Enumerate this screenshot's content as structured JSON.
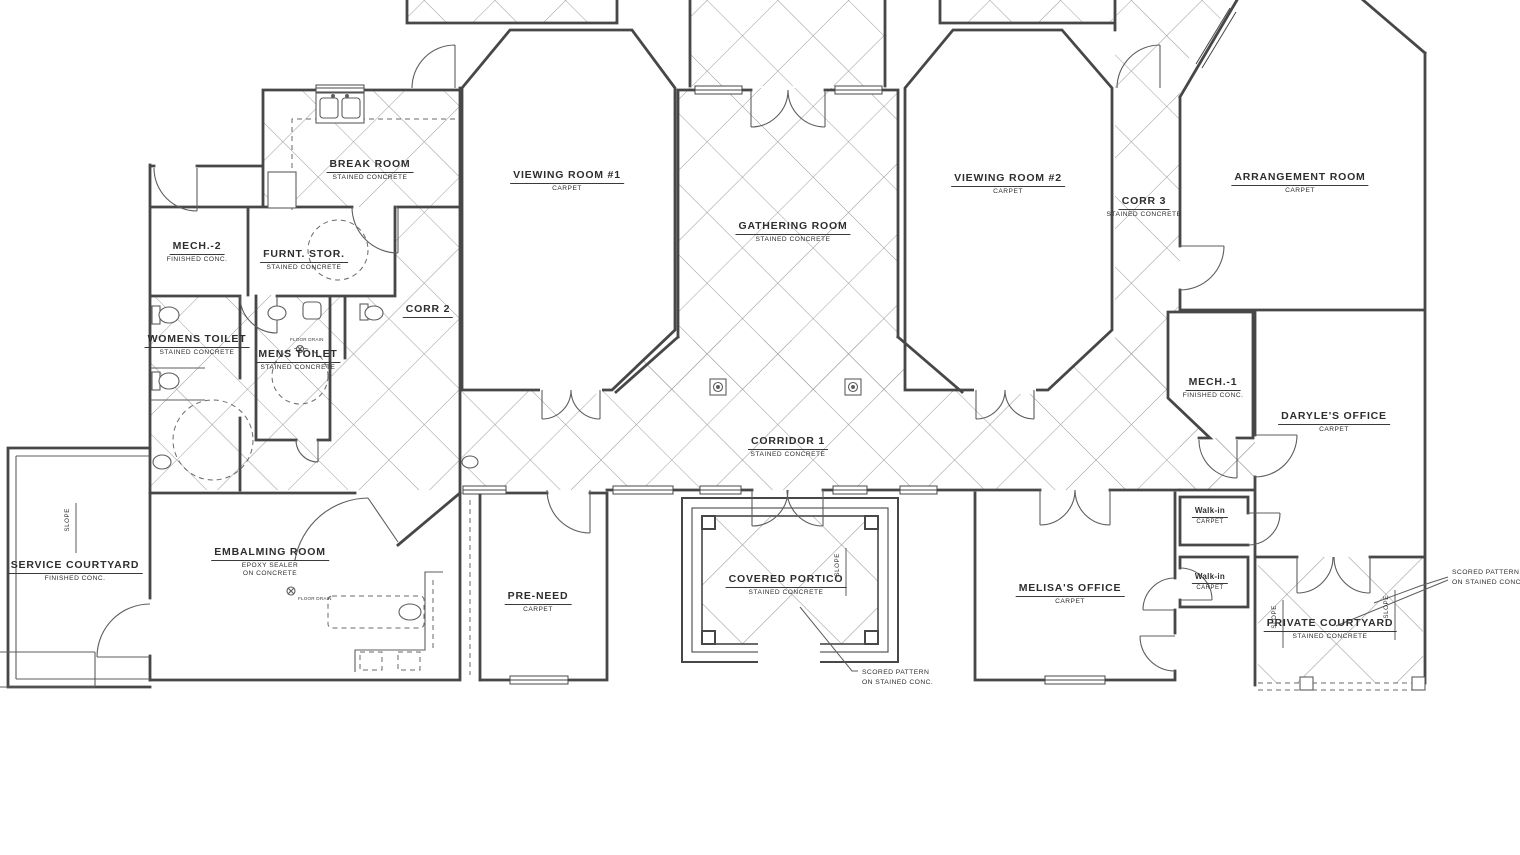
{
  "drawing": {
    "kind": "architectural floor plan",
    "background": "#ffffff",
    "wall_color": "#474747",
    "hatch_color": "#9a9a9a"
  },
  "rooms": [
    {
      "name": "BREAK ROOM",
      "finish": "STAINED CONCRETE"
    },
    {
      "name": "VIEWING ROOM #1",
      "finish": "CARPET"
    },
    {
      "name": "GATHERING ROOM",
      "finish": "STAINED CONCRETE"
    },
    {
      "name": "VIEWING ROOM #2",
      "finish": "CARPET"
    },
    {
      "name": "CORR 3",
      "finish": "STAINED CONCRETE"
    },
    {
      "name": "ARRANGEMENT ROOM",
      "finish": "CARPET"
    },
    {
      "name": "MECH.-2",
      "finish": "FINISHED CONC."
    },
    {
      "name": "FURNT. STOR.",
      "finish": "STAINED CONCRETE"
    },
    {
      "name": "CORR 2",
      "finish": ""
    },
    {
      "name": "WOMENS TOILET",
      "finish": "STAINED CONCRETE"
    },
    {
      "name": "MENS TOILET",
      "finish": "STAINED CONCRETE"
    },
    {
      "name": "MECH.-1",
      "finish": "FINISHED CONC."
    },
    {
      "name": "DARYLE'S OFFICE",
      "finish": "CARPET"
    },
    {
      "name": "CORRIDOR 1",
      "finish": "STAINED CONCRETE"
    },
    {
      "name": "SERVICE COURTYARD",
      "finish": "FINISHED CONC."
    },
    {
      "name": "EMBALMING ROOM",
      "finish": "EPOXY SEALER",
      "finish2": "ON CONCRETE"
    },
    {
      "name": "PRE-NEED",
      "finish": "CARPET"
    },
    {
      "name": "COVERED PORTICO",
      "finish": "STAINED CONCRETE"
    },
    {
      "name": "MELISA'S OFFICE",
      "finish": "CARPET"
    },
    {
      "name": "Walk-in",
      "finish": "CARPET"
    },
    {
      "name": "Walk-in",
      "finish": "CARPET"
    },
    {
      "name": "PRIVATE COURTYARD",
      "finish": "STAINED CONCRETE"
    }
  ],
  "annotations": {
    "scored_note_line1": "SCORED PATTERN",
    "scored_note_line2": "ON STAINED CONC.",
    "slope": "SLOPE",
    "floor_drain": "FLOOR DRAIN"
  }
}
